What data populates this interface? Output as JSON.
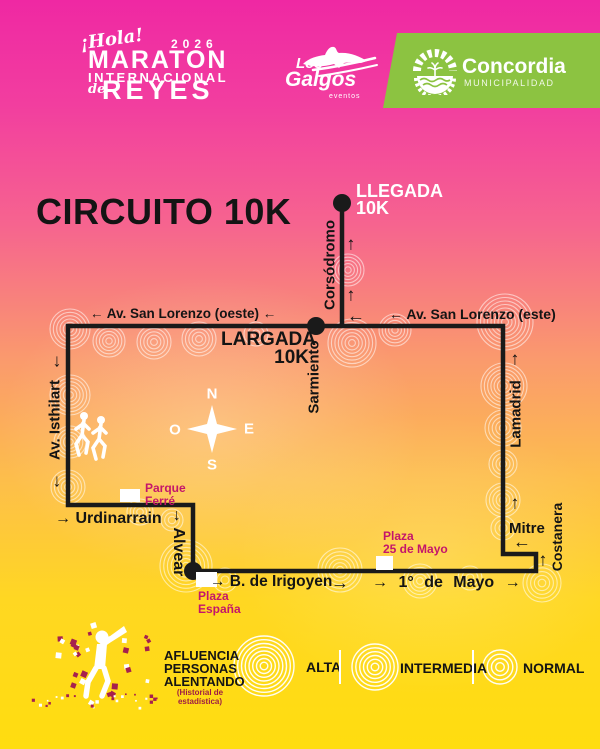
{
  "colors": {
    "bg_top": "#EF28A3",
    "bg_bottom": "#FFDD0F",
    "banner_green": "#8CC341",
    "poi_label": "#C4156B",
    "legend_subtitle": "#9E1C45",
    "route": "#1A1A1A",
    "white": "#FFFFFF",
    "confetti": [
      "#A6204E",
      "#FFFFFF"
    ]
  },
  "header": {
    "hola": "¡Hola!",
    "year": "2026",
    "maraton": "MARATON",
    "internacional": "INTERNACIONAL",
    "de": "de",
    "reyes": "REYES",
    "galgos": {
      "los": "Los",
      "name": "Galgos",
      "sub": "eventos"
    },
    "concordia": {
      "name": "Concordia",
      "sub": "MUNICIPALIDAD"
    }
  },
  "map": {
    "title": "CIRCUITO 10K",
    "llegada_line1": "LLEGADA",
    "llegada_line2": "10K",
    "largada_line1": "LARGADA",
    "largada_line2": "10K",
    "compass": {
      "n": "N",
      "o": "O",
      "e": "E",
      "s": "S"
    },
    "streets": {
      "san_lorenzo_oeste": "← Av. San Lorenzo (oeste) ←",
      "san_lorenzo_este": "← Av. San Lorenzo (este)",
      "corsodromo": "Corsódromo",
      "sarmiento": "Sarmiento",
      "isthilart": "Av. Isthilart",
      "urdinarrain": "→ Urdinarrain",
      "alvear": "→ Alvear",
      "irigoyen": "→ B. de Irigoyen",
      "mayo": "→ 1° de Mayo →",
      "mitre": "Mitre",
      "costanera": "Costanera",
      "lamadrid": "Lamadrid"
    },
    "arrows": [
      {
        "x": 356,
        "y": 316,
        "g": "←"
      },
      {
        "x": 351,
        "y": 244,
        "g": "↑"
      },
      {
        "x": 351,
        "y": 295,
        "g": "↑"
      },
      {
        "x": 57,
        "y": 361,
        "g": "↓"
      },
      {
        "x": 57,
        "y": 481,
        "g": "↓"
      },
      {
        "x": 515,
        "y": 359,
        "g": "↑"
      },
      {
        "x": 515,
        "y": 503,
        "g": "↑"
      },
      {
        "x": 543,
        "y": 560,
        "g": "↑"
      },
      {
        "x": 522,
        "y": 542,
        "g": "←"
      },
      {
        "x": 340,
        "y": 583,
        "g": "→"
      }
    ],
    "route": {
      "points": [
        [
          342,
          203
        ],
        [
          342,
          326
        ],
        [
          68,
          326
        ],
        [
          68,
          505
        ],
        [
          193,
          505
        ],
        [
          193,
          571
        ],
        [
          536,
          571
        ],
        [
          536,
          554
        ],
        [
          503,
          554
        ],
        [
          503,
          326
        ],
        [
          342,
          326
        ]
      ],
      "dots": [
        {
          "x": 342,
          "y": 203
        },
        {
          "x": 316,
          "y": 326
        },
        {
          "x": 193,
          "y": 571
        }
      ]
    },
    "squares": [
      {
        "x": 120,
        "y": 489,
        "w": 20,
        "h": 13
      },
      {
        "x": 196,
        "y": 572,
        "w": 21,
        "h": 15
      },
      {
        "x": 376,
        "y": 556,
        "w": 17,
        "h": 14
      }
    ],
    "pois": {
      "parque_ferre": {
        "l1": "Parque",
        "l2": "Ferré"
      },
      "plaza_espana": {
        "l1": "Plaza",
        "l2": "España"
      },
      "plaza_25": {
        "l1": "Plaza",
        "l2": "25 de Mayo"
      }
    },
    "ripples": [
      [
        70,
        329,
        20
      ],
      [
        109,
        341,
        16
      ],
      [
        154,
        342,
        17
      ],
      [
        199,
        339,
        17
      ],
      [
        256,
        334,
        12
      ],
      [
        352,
        343,
        24
      ],
      [
        395,
        330,
        16
      ],
      [
        505,
        322,
        28
      ],
      [
        348,
        270,
        16
      ],
      [
        70,
        395,
        20
      ],
      [
        70,
        442,
        16
      ],
      [
        68,
        487,
        17
      ],
      [
        140,
        512,
        13
      ],
      [
        172,
        520,
        11
      ],
      [
        186,
        566,
        26
      ],
      [
        225,
        580,
        12
      ],
      [
        340,
        570,
        22
      ],
      [
        420,
        581,
        17
      ],
      [
        470,
        578,
        12
      ],
      [
        542,
        583,
        19
      ],
      [
        503,
        500,
        17
      ],
      [
        503,
        528,
        12
      ],
      [
        504,
        386,
        23
      ],
      [
        503,
        428,
        18
      ],
      [
        503,
        464,
        14
      ]
    ]
  },
  "legend": {
    "title_lines": [
      "AFLUENCIA",
      "PERSONAS",
      "ALENTANDO"
    ],
    "subtitle": "(Historial de estadística)",
    "items": [
      {
        "label": "ALTA",
        "cx": 264,
        "cy": 666,
        "r": 30,
        "rings": 8
      },
      {
        "label": "INTERMEDIA",
        "cx": 375,
        "cy": 667,
        "r": 23,
        "rings": 6
      },
      {
        "label": "NORMAL",
        "cx": 500,
        "cy": 667,
        "r": 17,
        "rings": 4
      }
    ]
  }
}
